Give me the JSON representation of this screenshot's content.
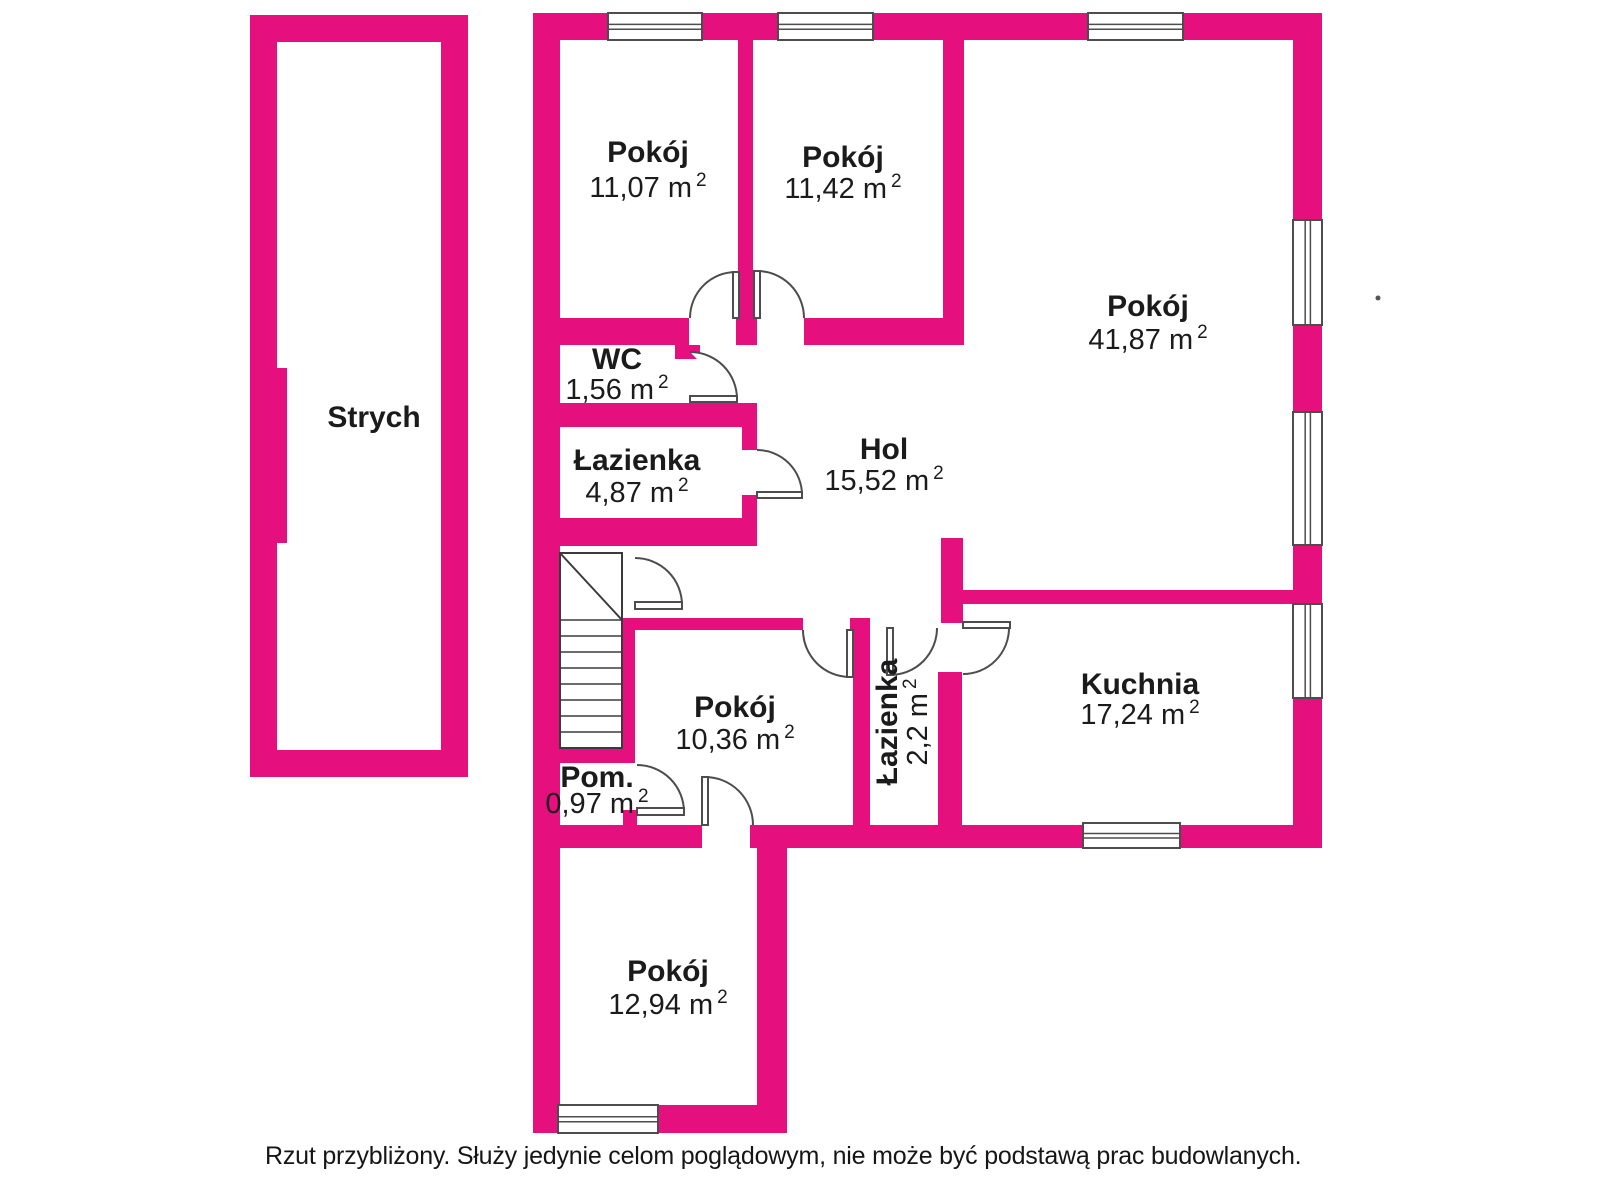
{
  "caption": "Rzut przybliżony. Służy jedynie celom poglądowym, nie może być podstawą prac budowlanych.",
  "colors": {
    "wall": "#E50F7E",
    "line": "#4d4d4d",
    "stair_line": "#3a3a3a",
    "text": "#1b1b1b",
    "background": "#ffffff"
  },
  "rooms": [
    {
      "id": "strych",
      "name": "Strych",
      "area": null,
      "label": {
        "x": 374,
        "name_y": 427
      }
    },
    {
      "id": "pokoj-11-07",
      "name": "Pokój",
      "area": "11,07",
      "label": {
        "x": 648,
        "name_y": 162,
        "area_y": 197
      }
    },
    {
      "id": "pokoj-11-42",
      "name": "Pokój",
      "area": "11,42",
      "label": {
        "x": 843,
        "name_y": 167,
        "area_y": 198
      }
    },
    {
      "id": "pokoj-41-87",
      "name": "Pokój",
      "area": "41,87",
      "label": {
        "x": 1148,
        "name_y": 316,
        "area_y": 349
      }
    },
    {
      "id": "wc",
      "name": "WC",
      "area": "1,56",
      "label": {
        "x": 617,
        "name_y": 369,
        "area_y": 399
      }
    },
    {
      "id": "lazienka-4-87",
      "name": "Łazienka",
      "area": "4,87",
      "label": {
        "x": 637,
        "name_y": 470,
        "area_y": 502
      }
    },
    {
      "id": "hol",
      "name": "Hol",
      "area": "15,52",
      "label": {
        "x": 884,
        "name_y": 459,
        "area_y": 490
      }
    },
    {
      "id": "pokoj-10-36",
      "name": "Pokój",
      "area": "10,36",
      "label": {
        "x": 735,
        "name_y": 717,
        "area_y": 749
      }
    },
    {
      "id": "lazienka-2-2",
      "name": "Łazienka",
      "area": "2,2",
      "label": {
        "rotate": -90,
        "name_x": 897,
        "area_x": 927,
        "cy": 722
      }
    },
    {
      "id": "kuchnia",
      "name": "Kuchnia",
      "area": "17,24",
      "label": {
        "x": 1140,
        "name_y": 694,
        "area_y": 724
      }
    },
    {
      "id": "pom",
      "name": "Pom.",
      "area": "0,97",
      "label": {
        "x": 597,
        "name_y": 787,
        "area_y": 813
      }
    },
    {
      "id": "pokoj-12-94",
      "name": "Pokój",
      "area": "12,94",
      "label": {
        "x": 668,
        "name_y": 981,
        "area_y": 1014
      }
    }
  ],
  "plan": {
    "width": 1600,
    "height": 1200,
    "walls": [
      [
        250,
        15,
        218,
        27
      ],
      [
        250,
        15,
        27,
        762
      ],
      [
        277,
        368,
        10,
        175
      ],
      [
        441,
        15,
        27,
        762
      ],
      [
        250,
        750,
        218,
        27
      ],
      [
        533,
        13,
        75,
        27
      ],
      [
        702,
        13,
        76,
        27
      ],
      [
        873,
        13,
        215,
        27
      ],
      [
        1183,
        13,
        139,
        27
      ],
      [
        533,
        13,
        27,
        1120
      ],
      [
        1293,
        13,
        29,
        207
      ],
      [
        1293,
        325,
        29,
        87
      ],
      [
        1293,
        545,
        29,
        59
      ],
      [
        1293,
        698,
        29,
        150
      ],
      [
        738,
        40,
        15,
        305
      ],
      [
        560,
        318,
        129,
        27
      ],
      [
        736,
        318,
        21,
        27
      ],
      [
        804,
        318,
        140,
        27
      ],
      [
        943,
        40,
        21,
        305
      ],
      [
        941,
        538,
        22,
        85
      ],
      [
        963,
        590,
        330,
        14
      ],
      [
        938,
        672,
        24,
        153
      ],
      [
        533,
        403,
        224,
        24
      ],
      [
        675,
        345,
        25,
        14
      ],
      [
        742,
        427,
        15,
        23
      ],
      [
        742,
        495,
        15,
        28
      ],
      [
        533,
        518,
        224,
        28
      ],
      [
        622,
        618,
        13,
        145
      ],
      [
        533,
        748,
        102,
        15
      ],
      [
        623,
        810,
        14,
        16
      ],
      [
        635,
        618,
        168,
        12
      ],
      [
        850,
        618,
        20,
        12
      ],
      [
        853,
        618,
        17,
        207
      ],
      [
        533,
        825,
        169,
        23
      ],
      [
        750,
        825,
        333,
        23
      ],
      [
        1180,
        825,
        142,
        23
      ],
      [
        757,
        847,
        30,
        286
      ],
      [
        533,
        1105,
        25,
        28
      ],
      [
        658,
        1105,
        129,
        28
      ]
    ],
    "windows": [
      {
        "rect": [
          608,
          13,
          94,
          27
        ],
        "dir": "h"
      },
      {
        "rect": [
          778,
          13,
          95,
          27
        ],
        "dir": "h"
      },
      {
        "rect": [
          1088,
          13,
          95,
          27
        ],
        "dir": "h"
      },
      {
        "rect": [
          1293,
          220,
          29,
          105
        ],
        "dir": "v"
      },
      {
        "rect": [
          1293,
          412,
          29,
          133
        ],
        "dir": "v"
      },
      {
        "rect": [
          1293,
          604,
          29,
          94
        ],
        "dir": "v"
      },
      {
        "rect": [
          1083,
          823,
          97,
          25
        ],
        "dir": "h"
      },
      {
        "rect": [
          558,
          1105,
          100,
          28
        ],
        "dir": "h"
      }
    ],
    "doors": [
      {
        "id": "door-pokoj-11-07",
        "arc": "M 690 318 A 46 46 0 0 1 736 272",
        "leaf": [
          733,
          272,
          6,
          46
        ]
      },
      {
        "id": "door-pokoj-11-42",
        "arc": "M 804 318 A 47 47 0 0 0 757 271",
        "leaf": [
          754,
          271,
          6,
          47
        ]
      },
      {
        "id": "door-wc",
        "arc": "M 737 399 A 47 47 0 0 0 690 352",
        "leaf": [
          690,
          396,
          47,
          6
        ]
      },
      {
        "id": "door-lazienka-487",
        "arc": "M 757 450 A 45 45 0 0 1 802 495",
        "leaf": [
          757,
          492,
          45,
          6
        ]
      },
      {
        "id": "door-stairs",
        "arc": "M 635 558 A 47 47 0 0 1 682 605",
        "leaf": [
          635,
          602,
          47,
          7
        ]
      },
      {
        "id": "door-pom",
        "arc": "M 637 765 A 47 47 0 0 1 684 812",
        "leaf": [
          637,
          808,
          47,
          7
        ]
      },
      {
        "id": "door-pokoj-12-94",
        "arc": "M 705 777 A 48 48 0 0 1 753 825",
        "leaf": [
          702,
          777,
          6,
          48
        ]
      },
      {
        "id": "door-pokoj-10-36",
        "arc": "M 803 630 A 47 47 0 0 0 850 677",
        "leaf": [
          847,
          630,
          6,
          47
        ]
      },
      {
        "id": "door-lazienka-22",
        "arc": "M 937 628 A 47 47 0 0 1 890 675",
        "leaf": [
          887,
          628,
          6,
          47
        ]
      },
      {
        "id": "door-kuchnia",
        "arc": "M 1009 628 A 46 46 0 0 1 963 674",
        "leaf": [
          963,
          622,
          47,
          6
        ]
      }
    ],
    "stairs": {
      "box": [
        560,
        553,
        62,
        195
      ],
      "diag": [
        560,
        553,
        622,
        620
      ],
      "tread_x": [
        560,
        622
      ],
      "tread_ys": [
        620,
        636,
        652,
        668,
        684,
        700,
        716,
        732
      ]
    },
    "dot": [
      1378,
      298
    ]
  }
}
